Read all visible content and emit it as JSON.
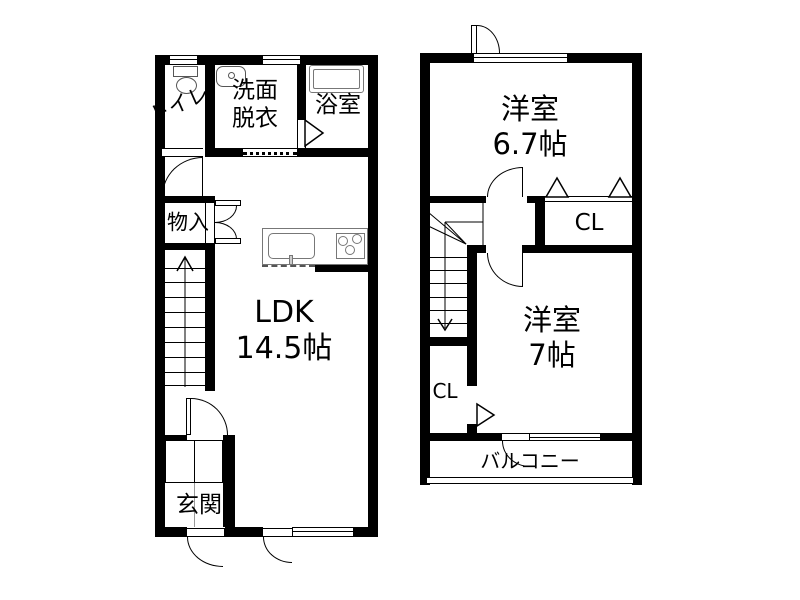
{
  "floor1": {
    "toilet_label": "トイレ",
    "washroom_label": "洗面\n脱衣",
    "bath_label": "浴室",
    "storage_label": "物入",
    "ldk_label": "LDK\n14.5帖",
    "entrance_label": "玄関"
  },
  "floor2": {
    "bedroom1_label": "洋室\n6.7帖",
    "closet1_label": "CL",
    "bedroom2_label": "洋室\n7帖",
    "closet2_label": "CL",
    "balcony_label": "バルコニー"
  },
  "colors": {
    "wall": "#000000",
    "background": "#ffffff",
    "fixture": "#777777"
  }
}
